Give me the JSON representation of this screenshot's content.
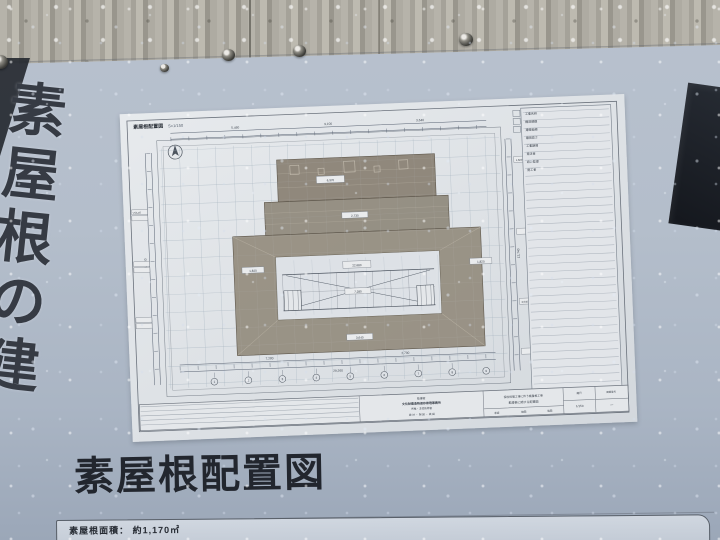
{
  "sign": {
    "banner_vertical": [
      "素",
      "屋",
      "根",
      "の",
      "建"
    ],
    "caption": "素屋根配置図",
    "area_strip": "素屋根面積： 約1,170㎡"
  },
  "sheet": {
    "title": "素屋根配置図",
    "scale": "S=1/150",
    "axis": [
      "1",
      "2",
      "3",
      "4",
      "5",
      "6",
      "7",
      "8",
      "9"
    ],
    "dims": [
      "29,260",
      "22,680",
      "9,100",
      "5,460",
      "3,640",
      "1,820",
      "7,280",
      "2,730",
      "14,560",
      "12,740",
      "▽GL±0",
      "6,370"
    ],
    "notes": [
      "工事名称",
      "構造規模",
      "建築面積",
      "最高高さ",
      "工事期間",
      "発注者",
      "設計監理",
      "施工者"
    ],
    "block": {
      "org1": "監理者",
      "org2": "文化財建造物保存修理事務所",
      "org3": "所長・主任技術者",
      "org4": "設 計 ・ 製 図 ・ 検 図",
      "proj1": "保存修理工事に伴う素屋根工事",
      "proj2": "素屋根に関する配置図",
      "approve": "承認",
      "check": "検図",
      "draft": "製図",
      "scale_label": "縮尺",
      "scale_val": "1/150",
      "no_label": "図面番号",
      "no_val": "—"
    }
  },
  "colors": {
    "sign_bg": "#b3bdca",
    "sheet_bg": "#dde1e6",
    "roof_fill": "#938b7e",
    "banner_dark": "#20242b",
    "ink": "#2d333b"
  }
}
